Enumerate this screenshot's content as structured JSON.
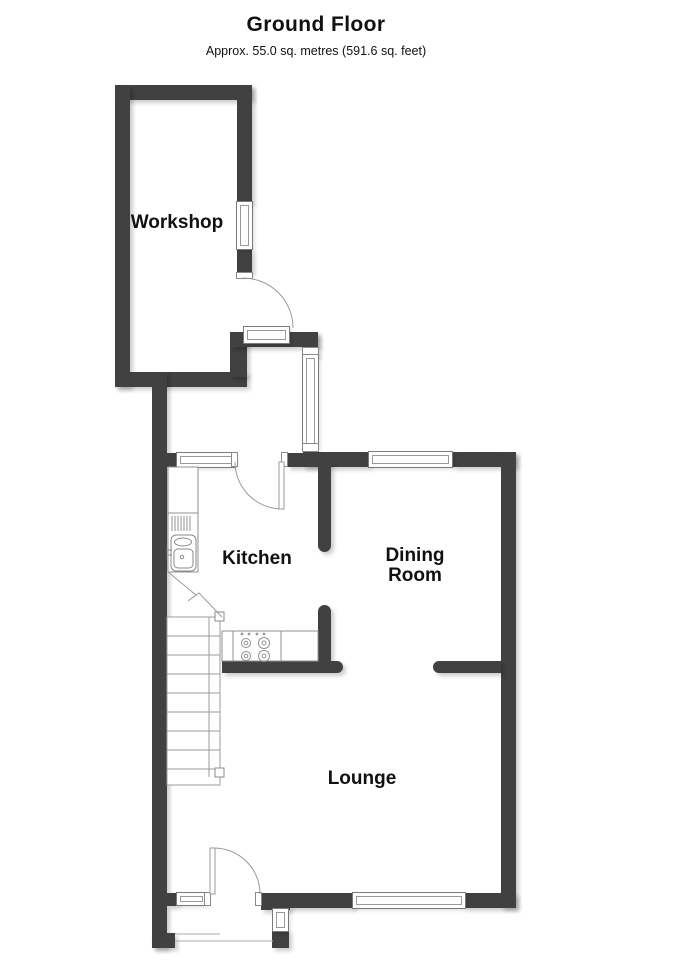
{
  "header": {
    "title": "Ground Floor",
    "subtitle": "Approx. 55.0 sq. metres (591.6 sq. feet)"
  },
  "rooms": {
    "workshop": {
      "label": "Workshop"
    },
    "kitchen": {
      "label": "Kitchen"
    },
    "dining": {
      "label": "Dining Room"
    },
    "lounge": {
      "label": "Lounge"
    }
  },
  "colors": {
    "wall": "#414141",
    "fixture_line": "#9b9b9b",
    "floor": "#ffffff",
    "text": "#111111"
  }
}
